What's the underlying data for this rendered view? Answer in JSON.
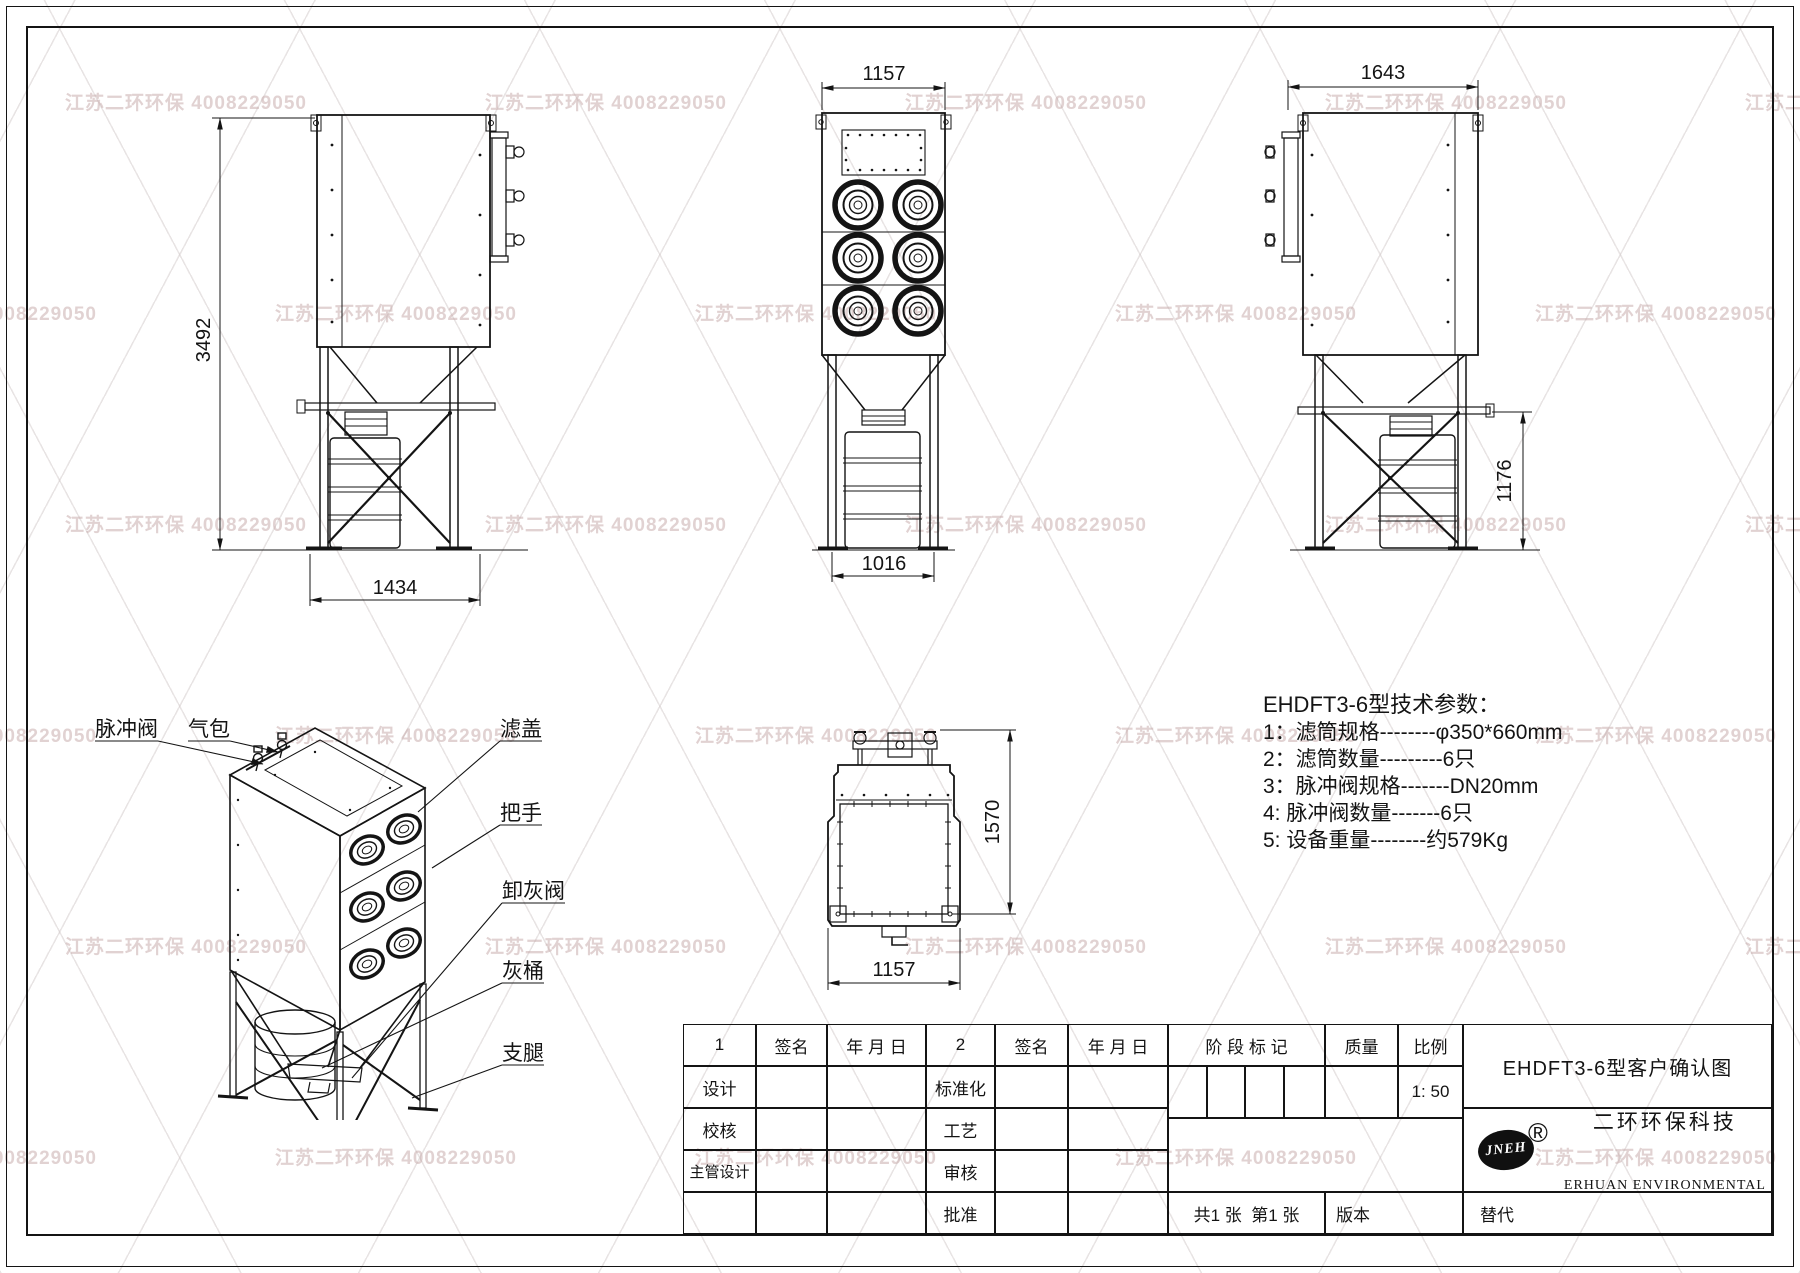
{
  "watermark": {
    "text": "江苏二环环保 4008229050"
  },
  "views": {
    "side_left": {
      "dim_height": "3492",
      "dim_width": "1434"
    },
    "front": {
      "dim_width_top": "1157",
      "dim_width_bottom": "1016"
    },
    "side_right": {
      "dim_width_top": "1643",
      "dim_height_lower": "1176"
    },
    "top": {
      "dim_depth": "1570",
      "dim_width": "1157"
    },
    "isometric": {
      "labels": {
        "pulse_valve": "脉冲阀",
        "air_bag": "气包",
        "filter_cover": "滤盖",
        "handle": "把手",
        "ash_valve": "卸灰阀",
        "ash_bucket": "灰桶",
        "support_leg": "支腿"
      }
    }
  },
  "tech_params": {
    "title": "EHDFT3-6型技术参数：",
    "items": [
      "1：滤筒规格--------φ350*660mm",
      "2：滤筒数量---------6只",
      "3：脉冲阀规格-------DN20mm",
      "4: 脉冲阀数量-------6只",
      "5: 设备重量--------约579Kg"
    ]
  },
  "title_block": {
    "col_group1": "1",
    "col_group2": "2",
    "sign_label": "签名",
    "date_label": "年 月 日",
    "stage_label": "阶 段 标 记",
    "weight_label": "质量",
    "scale_label": "比例",
    "scale_value": "1: 50",
    "row_design": "设计",
    "row_check": "校核",
    "row_chief": "主管设计",
    "row_standard": "标准化",
    "row_process": "工艺",
    "row_review": "审核",
    "row_approve": "批准",
    "sheet_info": "共1 张  第1 张",
    "version_label": "版本",
    "replace_label": "替代",
    "drawing_title": "EHDFT3-6型客户确认图",
    "logo_text": "JNEH",
    "registered_mark": "®",
    "company_cn": "二环环保科技",
    "company_en": "ERHUAN ENVIRONMENTAL"
  }
}
